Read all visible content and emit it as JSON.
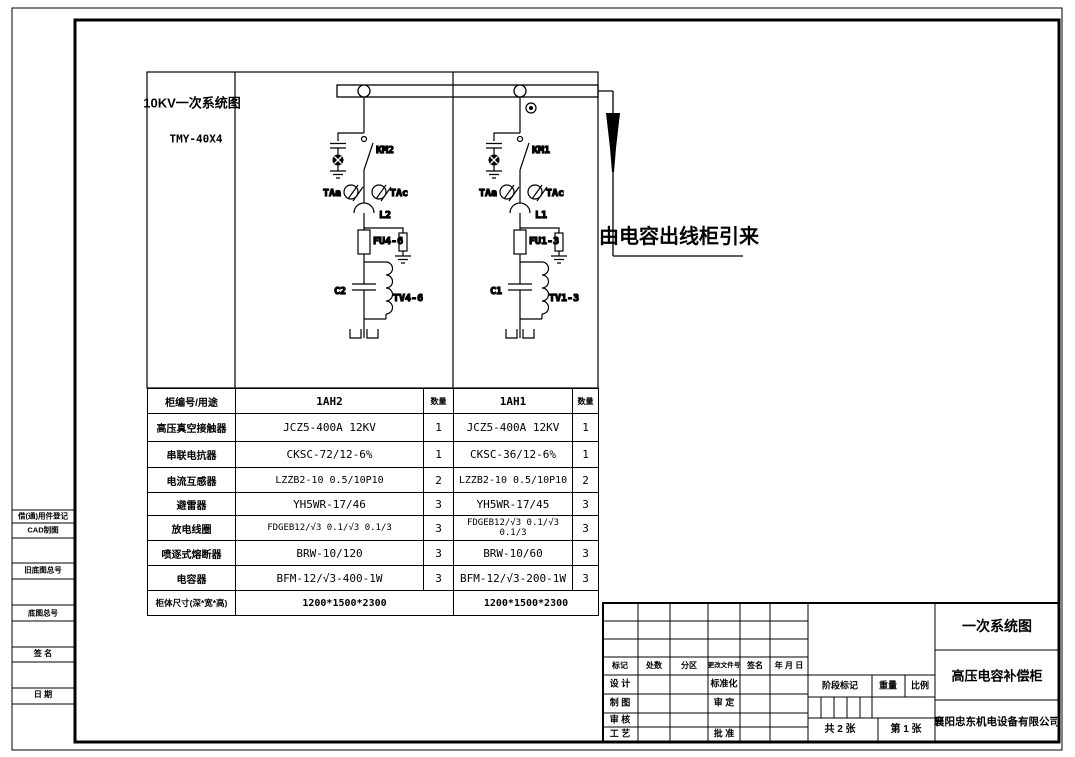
{
  "colors": {
    "ink": "#000000",
    "paper": "#ffffff"
  },
  "drawing": {
    "system_label": "10KV一次系统图",
    "bus_model": "TMY-40X4",
    "incoming_note": "由电容出线柜引来",
    "circuit1": {
      "contactor": "KM2",
      "ct_left": "TAa",
      "ct_right": "TAc",
      "reactor": "L2",
      "fuse": "FU4-6",
      "capacitor": "C2",
      "discharge_coil": "TV4-6"
    },
    "circuit2": {
      "contactor": "KM1",
      "ct_left": "TAa",
      "ct_right": "TAc",
      "reactor": "L1",
      "fuse": "FU1-3",
      "capacitor": "C1",
      "discharge_coil": "TV1-3"
    }
  },
  "equipment_table": {
    "header": {
      "label": "柜编号/用途",
      "cab1": "1AH2",
      "qty": "数量",
      "cab2": "1AH1"
    },
    "rows": [
      {
        "label": "高压真空接触器",
        "v1": "JCZ5-400A 12KV",
        "q1": "1",
        "v2": "JCZ5-400A 12KV",
        "q2": "1"
      },
      {
        "label": "串联电抗器",
        "v1": "CKSC-72/12-6%",
        "q1": "1",
        "v2": "CKSC-36/12-6%",
        "q2": "1"
      },
      {
        "label": "电流互感器",
        "v1": "LZZB2-10 0.5/10P10",
        "q1": "2",
        "v2": "LZZB2-10 0.5/10P10",
        "q2": "2"
      },
      {
        "label": "避雷器",
        "v1": "YH5WR-17/46",
        "q1": "3",
        "v2": "YH5WR-17/45",
        "q2": "3"
      },
      {
        "label": "放电线圈",
        "v1": "FDGEB12/√3 0.1/√3 0.1/3",
        "q1": "3",
        "v2": "FDGEB12/√3 0.1/√3 0.1/3",
        "q2": "3"
      },
      {
        "label": "喷逐式熔断器",
        "v1": "BRW-10/120",
        "q1": "3",
        "v2": "BRW-10/60",
        "q2": "3"
      },
      {
        "label": "电容器",
        "v1": "BFM-12/√3-400-1W",
        "q1": "3",
        "v2": "BFM-12/√3-200-1W",
        "q2": "3"
      }
    ],
    "footer": {
      "label": "柜体尺寸(深*宽*高)",
      "v1": "1200*1500*2300",
      "v2": "1200*1500*2300"
    }
  },
  "margin_labels": {
    "items": [
      "借(通)用件登记",
      "CAD制图",
      "旧底图总号",
      "底图总号",
      "签 名",
      "日 期"
    ]
  },
  "title_block": {
    "rev_header": {
      "c1": "标记",
      "c2": "处数",
      "c3": "分区",
      "c4": "更改文件号",
      "c5": "签名",
      "c6": "年 月 日"
    },
    "roles": {
      "r1l": "设 计",
      "r1m": "标准化",
      "r2l": "制 图",
      "r2m": "审 定",
      "r3l": "审 核",
      "r4l": "工 艺",
      "r4m": "批 准"
    },
    "stage": "阶段标记",
    "weight": "重量",
    "scale": "比例",
    "sheets_total": "共 2 张",
    "sheet_no": "第 1 张",
    "doc_title": "一次系统图",
    "product": "高压电容补偿柜",
    "company": "襄阳忠东机电设备有限公司"
  }
}
